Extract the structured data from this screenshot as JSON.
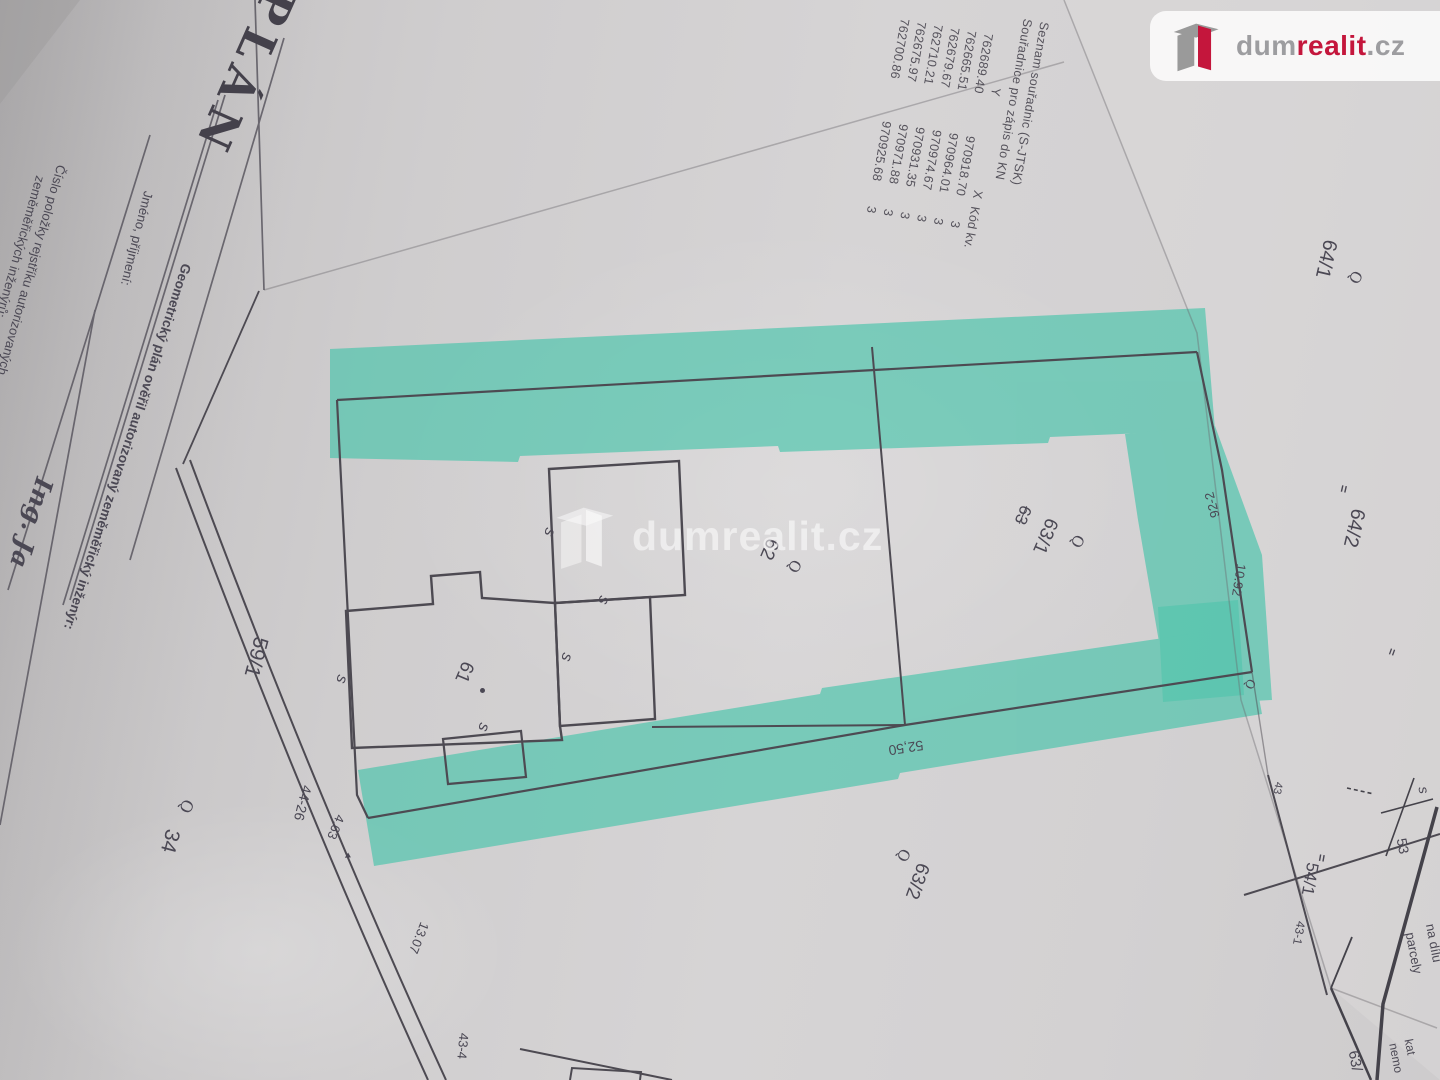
{
  "logo": {
    "dum": "dum",
    "realit": "realit",
    "cz": ".cz"
  },
  "watermark": {
    "text": "dumrealit.cz"
  },
  "coord_table": {
    "title1": "Seznam souřadnic (S-JTSK)",
    "title2": "Souřadnice pro zápis do KN",
    "col_y": "Y",
    "col_x": "X",
    "col_k": "Kód kv.",
    "rows": [
      {
        "y": "762689.40",
        "x": "970918.70",
        "k": "3"
      },
      {
        "y": "762665.51",
        "x": "970964.01",
        "k": "3"
      },
      {
        "y": "762679.67",
        "x": "970974.67",
        "k": "3"
      },
      {
        "y": "762710.21",
        "x": "970931.35",
        "k": "3"
      },
      {
        "y": "762675.97",
        "x": "970971.88",
        "k": "3"
      },
      {
        "y": "762700.86",
        "x": "970925.68",
        "k": "3"
      }
    ]
  },
  "form": {
    "title": "PLÁN",
    "verify": "Geometrický plán ověřil autorizovaný zeměměřický inženýr:",
    "name_label": "Jméno, příjmení:",
    "number_label1": "Číslo položky rejstříku autorizovaných",
    "number_label2": "zeměměřických inženýrů:",
    "engineer": "Ing. Ja"
  },
  "parcels": {
    "p59": "59/1",
    "p34": "34",
    "p61": "61",
    "p62": "62",
    "p63old": "63",
    "p631": "63/1",
    "p632": "63/2",
    "p641": "64/1",
    "p642": "64/2",
    "p541": "54/1"
  },
  "points": {
    "pt4426": "44-26",
    "pt922": "92-2",
    "pt431": "43-1",
    "pt434": "43-4",
    "pt43": "43"
  },
  "dims": {
    "d463": "4.63",
    "d1307": "13.07",
    "d5250": "52,50",
    "d1092": "10.92"
  },
  "marks": {
    "wall": "s",
    "loop": "Q",
    "ticks": "=",
    "arrow": "▸"
  },
  "under_sheet": {
    "s": "s",
    "n53": "53",
    "na_dilu": "na dílu",
    "parcely": "parcely",
    "kat": "kat",
    "nemo": "nemo",
    "p63": "63/"
  },
  "colors": {
    "highlight": "#3fc3a8",
    "line": "#4d4a52",
    "logo_red": "#c4163c"
  }
}
